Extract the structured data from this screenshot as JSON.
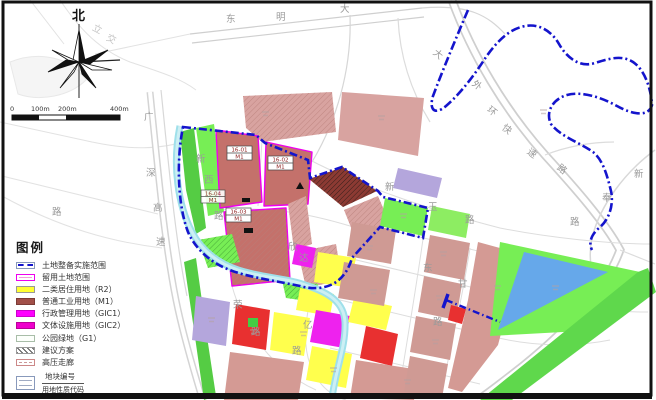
{
  "compass": {
    "north_label": "北"
  },
  "scale_bar": {
    "ticks": [
      "0",
      "100m",
      "200m",
      "400m"
    ]
  },
  "legend": {
    "title": "图例",
    "items": [
      {
        "key": "implementation-scope",
        "label": "土地整备实施范围"
      },
      {
        "key": "retained-land",
        "label": "留用土地范围"
      },
      {
        "key": "residential-r2",
        "label": "二类居住用地（R2）"
      },
      {
        "key": "industrial-m1",
        "label": "普通工业用地（M1）"
      },
      {
        "key": "admin-gic1",
        "label": "行政管理用地（GIC1）"
      },
      {
        "key": "culture-gic2",
        "label": "文体设施用地（GIC2）"
      },
      {
        "key": "park-g1",
        "label": "公园绿地（G1）"
      },
      {
        "key": "proposal",
        "label": "建议方案"
      },
      {
        "key": "hv-corridor",
        "label": "高压走廊"
      }
    ],
    "plot_code_sample": {
      "top": "地块编号",
      "bottom": "用地性质代码"
    }
  },
  "map": {
    "plots": [
      {
        "id": "16-01",
        "code": "M1"
      },
      {
        "id": "16-02",
        "code": "M1"
      },
      {
        "id": "16-03",
        "code": "M1"
      },
      {
        "id": "16-04",
        "code": "M1"
      }
    ],
    "road_labels": {
      "dongming": [
        "东",
        "明",
        "大"
      ],
      "outer_ring": [
        "大",
        "外",
        "环",
        "快",
        "速",
        "路"
      ],
      "xinfeng": [
        "新",
        "奉",
        "路"
      ],
      "guangshen": [
        "广",
        "深",
        "高",
        "速"
      ],
      "xinxi": [
        "新",
        "西",
        "路"
      ],
      "xinda": [
        "欣",
        "达"
      ],
      "xinyu": [
        "新",
        "玉",
        "路"
      ],
      "rong": [
        "荣",
        "路"
      ],
      "yi": [
        "亿",
        "路"
      ],
      "dong": [
        "东"
      ],
      "gan": [
        "甘"
      ],
      "lu_left": [
        "路"
      ],
      "lu_se": [
        "路"
      ],
      "lijiao": [
        "立",
        "交"
      ]
    },
    "colors": {
      "boundary_blue": "#1414cc",
      "retained_outline": "#ee00ee",
      "r2_yellow": "#ffff33",
      "m1_industrial": "#a14f48",
      "m1_plot": "#c4716b",
      "m1_dark_hatched": "#8c3a33",
      "gic1_magenta": "#ff00ff",
      "gic2_magenta": "#ee00cc",
      "park_green": "#77ee55",
      "strip_green": "#55cc44",
      "river_cyan": "#9fe0ea",
      "water_blue": "#66a8ea",
      "lavender": "#b4a6dc",
      "red_plot": "#e83030",
      "pale_rose": "#d8a3a0",
      "road_gray": "#cfcfcf"
    }
  }
}
